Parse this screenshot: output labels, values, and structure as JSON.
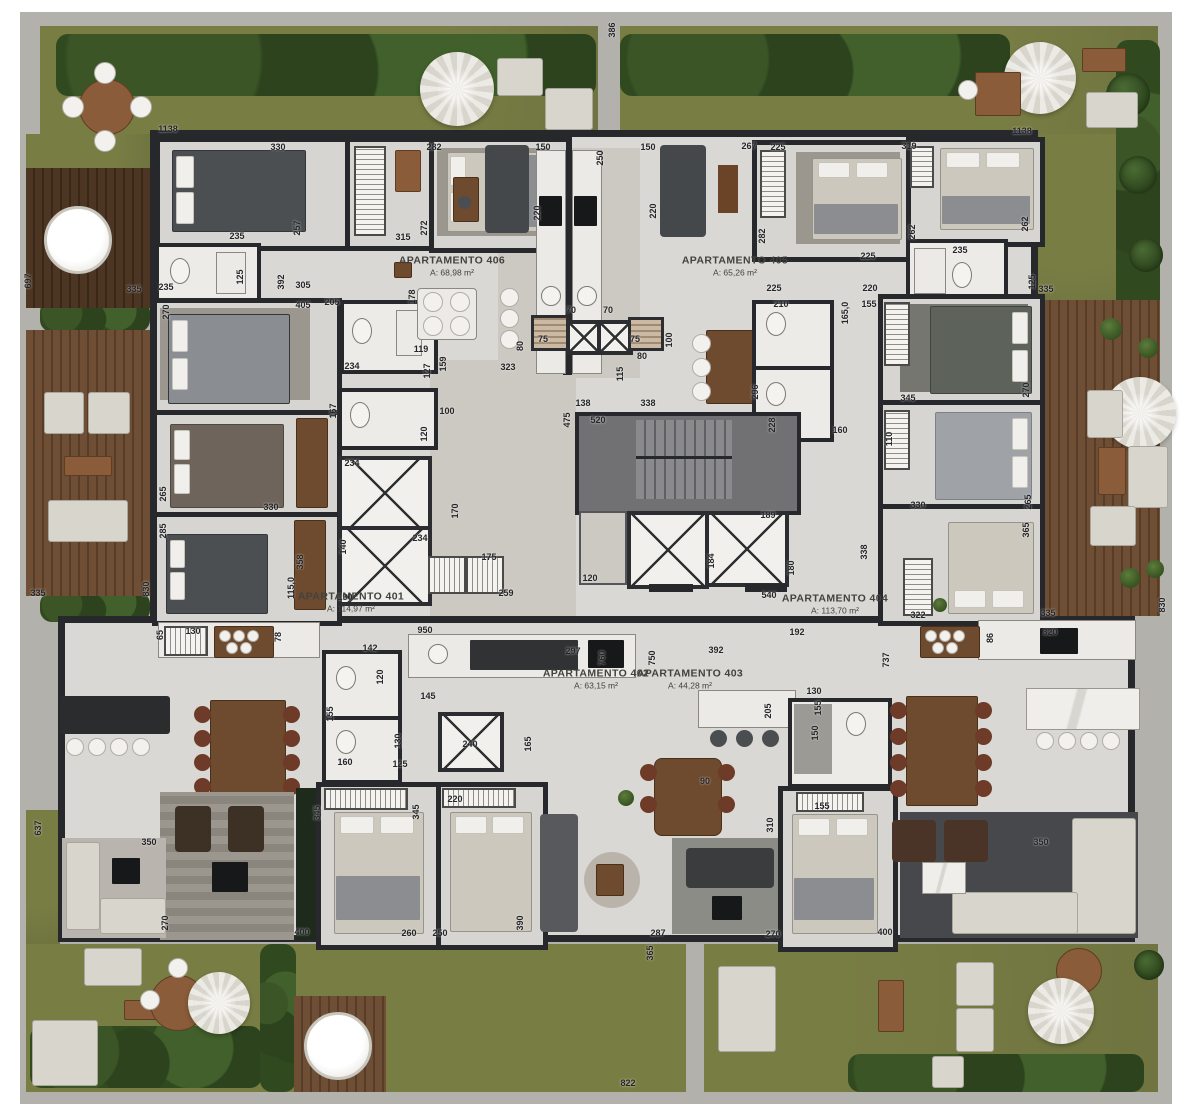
{
  "plan": {
    "width": 1192,
    "height": 1117,
    "type": "residential-floor-plan"
  },
  "colors": {
    "grass": "#6f7440",
    "hedge": "#31491f",
    "deck_wood": "#6e4f35",
    "concrete": "#b2b1ab",
    "floor": "#d9d8d4",
    "wall": "#26282b",
    "dimension_text": "#26262a",
    "fixture_white": "#f2f1ed"
  },
  "apartments": [
    {
      "name": "APARTAMENTO 406",
      "area": "A: 68,98 m²",
      "x": 452,
      "y": 266
    },
    {
      "name": "APARTAMENTO 405",
      "area": "A: 65,26 m²",
      "x": 735,
      "y": 266
    },
    {
      "name": "APARTAMENTO 401",
      "area": "A: 114,97 m²",
      "x": 351,
      "y": 602
    },
    {
      "name": "APARTAMENTO 402",
      "area": "A: 63,15 m²",
      "x": 596,
      "y": 679
    },
    {
      "name": "APARTAMENTO 403",
      "area": "A: 44,28 m²",
      "x": 690,
      "y": 679
    },
    {
      "name": "APARTAMENTO 404",
      "area": "A: 113,70 m²",
      "x": 835,
      "y": 604
    }
  ],
  "dimensions": [
    {
      "t": "1138",
      "x": 168,
      "y": 129
    },
    {
      "t": "330",
      "x": 278,
      "y": 147
    },
    {
      "t": "282",
      "x": 434,
      "y": 147
    },
    {
      "t": "150",
      "x": 543,
      "y": 147
    },
    {
      "t": "250",
      "x": 600,
      "y": 158,
      "r": 1
    },
    {
      "t": "150",
      "x": 648,
      "y": 147
    },
    {
      "t": "267",
      "x": 749,
      "y": 146
    },
    {
      "t": "225",
      "x": 778,
      "y": 147
    },
    {
      "t": "319",
      "x": 909,
      "y": 146
    },
    {
      "t": "1138",
      "x": 1022,
      "y": 131
    },
    {
      "t": "220",
      "x": 537,
      "y": 213,
      "r": 1
    },
    {
      "t": "220",
      "x": 653,
      "y": 211,
      "r": 1
    },
    {
      "t": "235",
      "x": 237,
      "y": 236
    },
    {
      "t": "257",
      "x": 297,
      "y": 228,
      "r": 1
    },
    {
      "t": "315",
      "x": 403,
      "y": 237
    },
    {
      "t": "272",
      "x": 424,
      "y": 228,
      "r": 1
    },
    {
      "t": "282",
      "x": 762,
      "y": 236,
      "r": 1
    },
    {
      "t": "262",
      "x": 912,
      "y": 232,
      "r": 1
    },
    {
      "t": "262",
      "x": 1025,
      "y": 224,
      "r": 1
    },
    {
      "t": "235",
      "x": 960,
      "y": 250
    },
    {
      "t": "225",
      "x": 868,
      "y": 256
    },
    {
      "t": "235",
      "x": 166,
      "y": 287
    },
    {
      "t": "125",
      "x": 240,
      "y": 277,
      "r": 1
    },
    {
      "t": "392",
      "x": 281,
      "y": 282,
      "r": 1
    },
    {
      "t": "305",
      "x": 303,
      "y": 285
    },
    {
      "t": "405",
      "x": 303,
      "y": 305
    },
    {
      "t": "205",
      "x": 332,
      "y": 302
    },
    {
      "t": "225",
      "x": 774,
      "y": 288
    },
    {
      "t": "220",
      "x": 870,
      "y": 288
    },
    {
      "t": "210",
      "x": 781,
      "y": 304
    },
    {
      "t": "155",
      "x": 869,
      "y": 304
    },
    {
      "t": "125",
      "x": 1032,
      "y": 282,
      "r": 1
    },
    {
      "t": "335",
      "x": 1046,
      "y": 289
    },
    {
      "t": "335",
      "x": 134,
      "y": 289
    },
    {
      "t": "697",
      "x": 28,
      "y": 281,
      "r": 1
    },
    {
      "t": "386",
      "x": 612,
      "y": 30,
      "r": 1
    },
    {
      "t": "178",
      "x": 412,
      "y": 297,
      "r": 1
    },
    {
      "t": "119",
      "x": 421,
      "y": 349
    },
    {
      "t": "159",
      "x": 443,
      "y": 364,
      "r": 1
    },
    {
      "t": "127",
      "x": 427,
      "y": 371,
      "r": 1
    },
    {
      "t": "234",
      "x": 352,
      "y": 366
    },
    {
      "t": "167",
      "x": 333,
      "y": 411,
      "r": 1
    },
    {
      "t": "100",
      "x": 447,
      "y": 411
    },
    {
      "t": "234",
      "x": 352,
      "y": 463
    },
    {
      "t": "120",
      "x": 424,
      "y": 434,
      "r": 1
    },
    {
      "t": "170",
      "x": 455,
      "y": 511,
      "r": 1
    },
    {
      "t": "140",
      "x": 343,
      "y": 547,
      "r": 1
    },
    {
      "t": "234",
      "x": 420,
      "y": 538
    },
    {
      "t": "175",
      "x": 489,
      "y": 557
    },
    {
      "t": "259",
      "x": 506,
      "y": 593
    },
    {
      "t": "190",
      "x": 345,
      "y": 597
    },
    {
      "t": "358",
      "x": 300,
      "y": 562,
      "r": 1
    },
    {
      "t": "115,0",
      "x": 291,
      "y": 588,
      "r": 1
    },
    {
      "t": "265",
      "x": 163,
      "y": 494,
      "r": 1
    },
    {
      "t": "285",
      "x": 163,
      "y": 531,
      "r": 1
    },
    {
      "t": "270",
      "x": 166,
      "y": 312,
      "r": 1
    },
    {
      "t": "330",
      "x": 271,
      "y": 507
    },
    {
      "t": "80",
      "x": 520,
      "y": 346,
      "r": 1
    },
    {
      "t": "75",
      "x": 543,
      "y": 339
    },
    {
      "t": "75",
      "x": 635,
      "y": 339
    },
    {
      "t": "70",
      "x": 571,
      "y": 310
    },
    {
      "t": "70",
      "x": 608,
      "y": 310
    },
    {
      "t": "80",
      "x": 642,
      "y": 356
    },
    {
      "t": "100",
      "x": 669,
      "y": 340,
      "r": 1
    },
    {
      "t": "323",
      "x": 508,
      "y": 367
    },
    {
      "t": "115",
      "x": 620,
      "y": 374,
      "r": 1
    },
    {
      "t": "138",
      "x": 583,
      "y": 403
    },
    {
      "t": "338",
      "x": 648,
      "y": 403
    },
    {
      "t": "475",
      "x": 567,
      "y": 420,
      "r": 1
    },
    {
      "t": "520",
      "x": 598,
      "y": 420
    },
    {
      "t": "296",
      "x": 755,
      "y": 392,
      "r": 1
    },
    {
      "t": "228",
      "x": 772,
      "y": 425,
      "r": 1
    },
    {
      "t": "189",
      "x": 768,
      "y": 515
    },
    {
      "t": "184",
      "x": 711,
      "y": 561,
      "r": 1
    },
    {
      "t": "180",
      "x": 791,
      "y": 568,
      "r": 1
    },
    {
      "t": "120",
      "x": 590,
      "y": 578
    },
    {
      "t": "540",
      "x": 769,
      "y": 595
    },
    {
      "t": "165,0",
      "x": 845,
      "y": 313,
      "r": 1
    },
    {
      "t": "160",
      "x": 840,
      "y": 430
    },
    {
      "t": "110",
      "x": 889,
      "y": 439,
      "r": 1
    },
    {
      "t": "345",
      "x": 908,
      "y": 398
    },
    {
      "t": "330",
      "x": 918,
      "y": 505
    },
    {
      "t": "265",
      "x": 1028,
      "y": 502,
      "r": 1
    },
    {
      "t": "365",
      "x": 1026,
      "y": 530,
      "r": 1
    },
    {
      "t": "270",
      "x": 1026,
      "y": 390,
      "r": 1
    },
    {
      "t": "338",
      "x": 864,
      "y": 552,
      "r": 1
    },
    {
      "t": "322",
      "x": 918,
      "y": 615
    },
    {
      "t": "192",
      "x": 797,
      "y": 632
    },
    {
      "t": "86",
      "x": 990,
      "y": 638,
      "r": 1
    },
    {
      "t": "335",
      "x": 1048,
      "y": 613
    },
    {
      "t": "830",
      "x": 1162,
      "y": 605,
      "r": 1
    },
    {
      "t": "320",
      "x": 1050,
      "y": 632
    },
    {
      "t": "335",
      "x": 38,
      "y": 593
    },
    {
      "t": "830",
      "x": 146,
      "y": 589,
      "r": 1
    },
    {
      "t": "65",
      "x": 160,
      "y": 635,
      "r": 1
    },
    {
      "t": "130",
      "x": 193,
      "y": 631
    },
    {
      "t": "78",
      "x": 278,
      "y": 637,
      "r": 1
    },
    {
      "t": "637",
      "x": 38,
      "y": 828,
      "r": 1
    },
    {
      "t": "737",
      "x": 886,
      "y": 660,
      "r": 1
    },
    {
      "t": "950",
      "x": 425,
      "y": 630
    },
    {
      "t": "142",
      "x": 370,
      "y": 648
    },
    {
      "t": "297",
      "x": 573,
      "y": 651
    },
    {
      "t": "392",
      "x": 716,
      "y": 650
    },
    {
      "t": "760",
      "x": 602,
      "y": 658,
      "r": 1
    },
    {
      "t": "750",
      "x": 652,
      "y": 658,
      "r": 1
    },
    {
      "t": "120",
      "x": 380,
      "y": 677,
      "r": 1
    },
    {
      "t": "145",
      "x": 428,
      "y": 696
    },
    {
      "t": "240",
      "x": 470,
      "y": 744
    },
    {
      "t": "165",
      "x": 528,
      "y": 744,
      "r": 1
    },
    {
      "t": "130",
      "x": 398,
      "y": 741,
      "r": 1
    },
    {
      "t": "155",
      "x": 330,
      "y": 714,
      "r": 1
    },
    {
      "t": "160",
      "x": 345,
      "y": 762
    },
    {
      "t": "125",
      "x": 400,
      "y": 764
    },
    {
      "t": "220",
      "x": 455,
      "y": 799
    },
    {
      "t": "345",
      "x": 317,
      "y": 813,
      "r": 1
    },
    {
      "t": "345",
      "x": 416,
      "y": 812,
      "r": 1
    },
    {
      "t": "130",
      "x": 814,
      "y": 691
    },
    {
      "t": "155",
      "x": 818,
      "y": 708,
      "r": 1
    },
    {
      "t": "150",
      "x": 815,
      "y": 733,
      "r": 1
    },
    {
      "t": "205",
      "x": 768,
      "y": 711,
      "r": 1
    },
    {
      "t": "90",
      "x": 705,
      "y": 781
    },
    {
      "t": "155",
      "x": 822,
      "y": 806
    },
    {
      "t": "310",
      "x": 770,
      "y": 825,
      "r": 1
    },
    {
      "t": "270",
      "x": 773,
      "y": 934
    },
    {
      "t": "287",
      "x": 658,
      "y": 933
    },
    {
      "t": "365",
      "x": 650,
      "y": 953,
      "r": 1
    },
    {
      "t": "400",
      "x": 885,
      "y": 932
    },
    {
      "t": "400",
      "x": 302,
      "y": 932
    },
    {
      "t": "350",
      "x": 1041,
      "y": 842
    },
    {
      "t": "350",
      "x": 149,
      "y": 842
    },
    {
      "t": "270",
      "x": 165,
      "y": 923,
      "r": 1
    },
    {
      "t": "390",
      "x": 520,
      "y": 923,
      "r": 1
    },
    {
      "t": "260",
      "x": 409,
      "y": 933
    },
    {
      "t": "250",
      "x": 440,
      "y": 933
    },
    {
      "t": "822",
      "x": 628,
      "y": 1083
    }
  ]
}
